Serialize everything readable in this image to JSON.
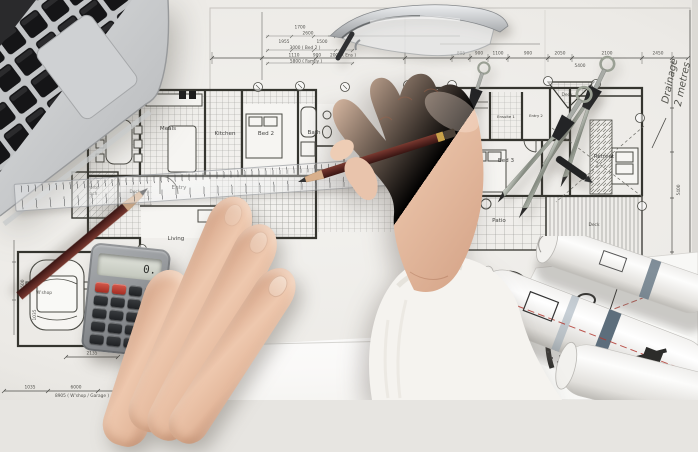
{
  "scene": {
    "description": "Top-down photograph: architect's hands drawing with a pencil and ruler over blueprint floor plans, surrounded by a laptop, pocket calculator, safety glasses, drafting compasses, a second pencil and rolled-up plans"
  },
  "colors": {
    "paper": "#edebe7",
    "ink": "#3a3a38",
    "wall": "#33332f",
    "skin": "#e8c3aa",
    "sleeve": "#f5f3ef",
    "pencil_body": "#5d2823",
    "laptop_body": "#c6c8ca",
    "laptop_key": "#161618",
    "calculator_body": "#8d9093",
    "calculator_key": "#2a2c2e",
    "calculator_red": "#c04038",
    "compass_metal": "#9aa094",
    "roll_tape_blue": "#5d6e7c",
    "roll_red_line": "#b23a32"
  },
  "blueprint": {
    "rooms": {
      "meals": "Meals",
      "kitchen": "Kitchen",
      "bed2": "Bed 2",
      "bath": "Bath",
      "entry": "Entry",
      "living": "Living",
      "porte1": "Porte",
      "porte2": "coch.",
      "deck_left": "Deck",
      "wshop": "W'shop",
      "garage": "Garage",
      "spa": "Spa",
      "deck_mid": "Deck",
      "sauna": "Sauna",
      "ensuite": "Ensuite 1",
      "entry2": "Entry 2",
      "deck_top": "Deck",
      "bed3": "Bed 3",
      "retreat": "Retreat",
      "patio": "Patio",
      "deck_right": "Deck"
    },
    "dims_top": [
      "805",
      "900",
      "1100",
      "900",
      "2050",
      "2100",
      "2450",
      "5400"
    ],
    "dims_left_block": [
      "1700",
      "2600",
      "1955",
      "1500",
      "3000 ( Bed 2 )",
      "1110",
      "900",
      "2000 ( Ens )",
      "5800 ( Family )"
    ],
    "dims_left_edge": [
      "1500",
      "1035"
    ],
    "dims_bottom_left": [
      "2135",
      "1035",
      "6000",
      "8905 ( W'shop / Garage )"
    ],
    "dims_bottom_right": [
      "4400 ( Bed 3 )",
      "1390",
      "1610"
    ],
    "dims_right": [
      "5400"
    ],
    "drainage_note": {
      "line1": "Drainage",
      "line2": "2 metres"
    }
  },
  "objects": {
    "calculator": {
      "display": "0."
    }
  }
}
